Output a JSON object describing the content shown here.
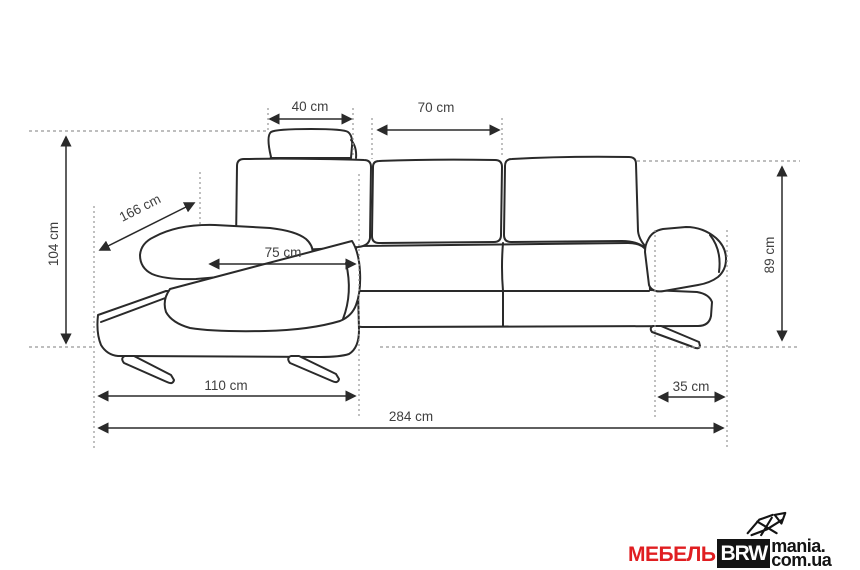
{
  "diagram": {
    "title": "corner-sofa-dimensions",
    "labels": {
      "headrest_width": "40 cm",
      "middle_backrest_width": "70 cm",
      "overall_height": "104 cm",
      "chaise_diagonal_length": "166 cm",
      "seat_width": "75 cm",
      "backrest_height": "89 cm",
      "chaise_width": "110 cm",
      "armrest_width": "35 cm",
      "overall_length": "284 cm"
    },
    "colors": {
      "outline": "#2a2a2a",
      "guide": "#979797",
      "label_text": "#3f3f3f"
    }
  },
  "watermark": {
    "prefix": "МЕБЕЛЬ",
    "box": "BRW",
    "suffix_line1": "mania.",
    "suffix_line2": "com.ua",
    "colors": {
      "prefix_red": "#e01e21",
      "box_bg": "#141414",
      "box_text": "#ffffff",
      "suffix_text": "#141414"
    }
  }
}
